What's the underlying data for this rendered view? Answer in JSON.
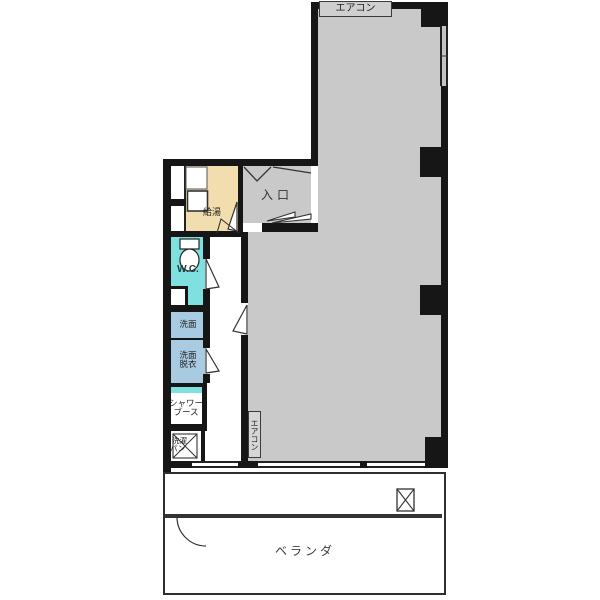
{
  "floorplan": {
    "labels": {
      "aircon_top": "エアコン",
      "aircon_wall": "エアコン",
      "entrance": "入口",
      "hot_water": "給湯",
      "wc": "W.C.",
      "washbasin": "洗面",
      "dressing_line1": "洗面",
      "dressing_line2": "脱衣",
      "shower_line1": "シャワー",
      "shower_line2": "ブース",
      "laundry_line1": "洗濯",
      "laundry_line2": "パン",
      "veranda": "ベランダ"
    },
    "colors": {
      "wall": "#161616",
      "room_gray": "#c9c9c9",
      "kitchen_beige": "#f2ddae",
      "wc_cyan": "#7fe0e0",
      "washroom_blue": "#a9cbe2",
      "label_box_gray": "#cfcfcf"
    }
  }
}
